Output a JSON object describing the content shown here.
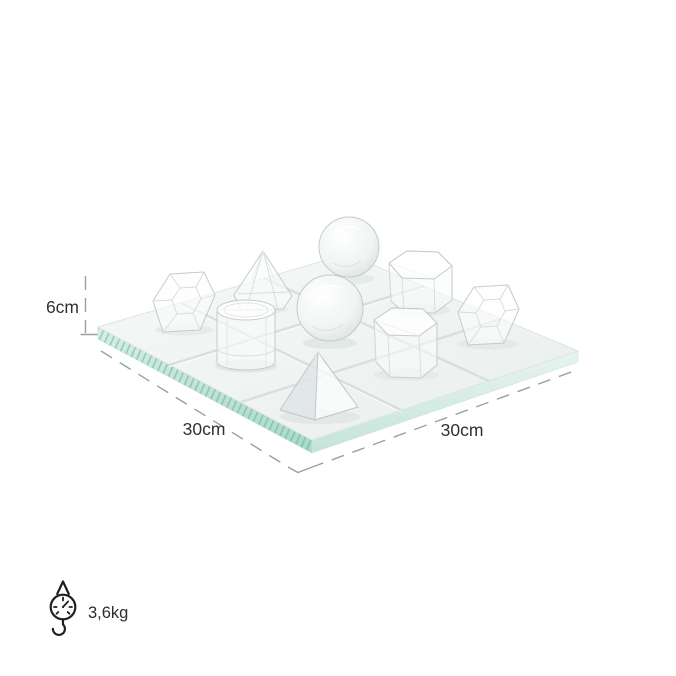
{
  "annotations": {
    "height": "6cm",
    "width": "30cm",
    "depth": "30cm",
    "weight": "3,6kg"
  },
  "icons": {
    "weight": "hanging-scale-icon"
  },
  "board_pieces": [
    "faceted-gem",
    "tall-pyramid",
    "sphere",
    "hexagonal-prism",
    "sphere",
    "hexagonal-prism",
    "faceted-gem",
    "cylinder",
    "pyramid"
  ],
  "colors": {
    "text": "#2f3232",
    "dimension_line": "#9aa0a0",
    "glass_edge": "#a9d8c7",
    "glass_face_light": "#f5f7f6",
    "glass_face_dark": "#e7edeb",
    "crystal_stroke": "#c4cbcd"
  }
}
